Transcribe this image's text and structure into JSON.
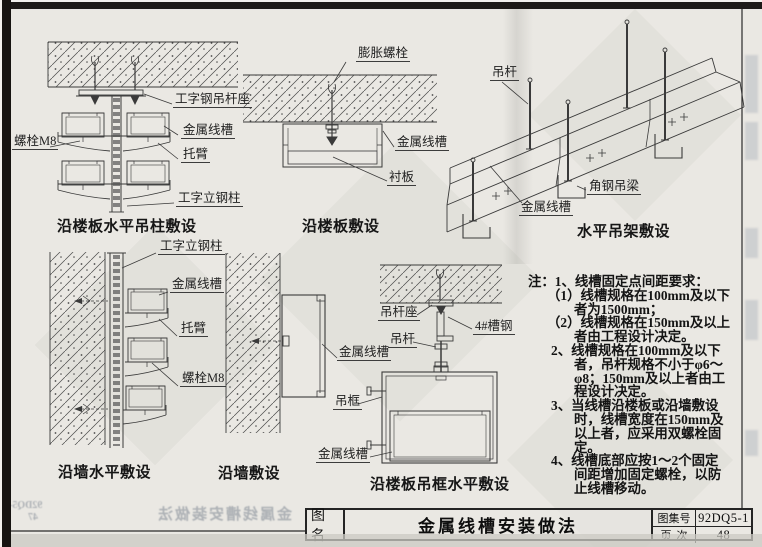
{
  "title_block": {
    "name_label": "图名",
    "title": "金属线槽安装做法",
    "atlas_label": "图集号",
    "atlas_no": "92DQ5-1",
    "page_label": "页次",
    "page_no": "48"
  },
  "diagrams": {
    "d1": {
      "caption": "沿楼板水平吊柱敷设",
      "labels": {
        "bolt": "螺栓M8",
        "hanger_seat": "工字钢吊杆座",
        "wireway": "金属线槽",
        "bracket": "托臂",
        "column": "工字立钢柱"
      }
    },
    "d2": {
      "caption": "沿楼板敷设",
      "labels": {
        "expansion_bolt": "膨胀螺栓",
        "wireway": "金属线槽",
        "liner": "衬板"
      }
    },
    "d3": {
      "caption": "水平吊架敷设",
      "labels": {
        "hanger_rod": "吊杆",
        "angle_beam": "角钢吊梁",
        "wireway": "金属线槽"
      }
    },
    "d4": {
      "caption": "沿墙水平敷设",
      "labels": {
        "column": "工字立钢柱",
        "wireway": "金属线槽",
        "bracket": "托臂",
        "bolt": "螺栓M8"
      }
    },
    "d5": {
      "caption": "沿墙敷设",
      "labels": {
        "wireway": "金属线槽"
      }
    },
    "d6": {
      "caption": "沿楼板吊框水平敷设",
      "labels": {
        "rod_seat": "吊杆座",
        "channel": "4#槽钢",
        "rod": "吊杆",
        "frame": "吊框",
        "wireway": "金属线槽"
      }
    }
  },
  "notes": {
    "lines": [
      "注：1、线槽固定点间距要求：",
      "（1）线槽规格在100mm及以下",
      "者为1500mm；",
      "（2）线槽规格在150mm及以上",
      "者由工程设计决定。",
      "2、线槽规格在100mm及以下",
      "者，吊杆规格不小于φ6～",
      "φ8；150mm及以上者由工",
      "程设计决定。",
      "3、当线槽沿楼板或沿墙敷设",
      "时，线槽宽度在150mm及",
      "以上者，应采用双螺栓固",
      "定。",
      "4、线槽底部应按1～2个固定",
      "间距增加固定螺栓，以防",
      "止线槽移动。"
    ]
  },
  "artifacts": {
    "bleed_title": "金属线槽安装做法",
    "bleed_atlas": "92DQ5-1",
    "bleed_page": "47"
  },
  "colors": {
    "paper": "#eae8e3",
    "ink": "#3a3a3a",
    "edge": "#1c1c1c"
  }
}
